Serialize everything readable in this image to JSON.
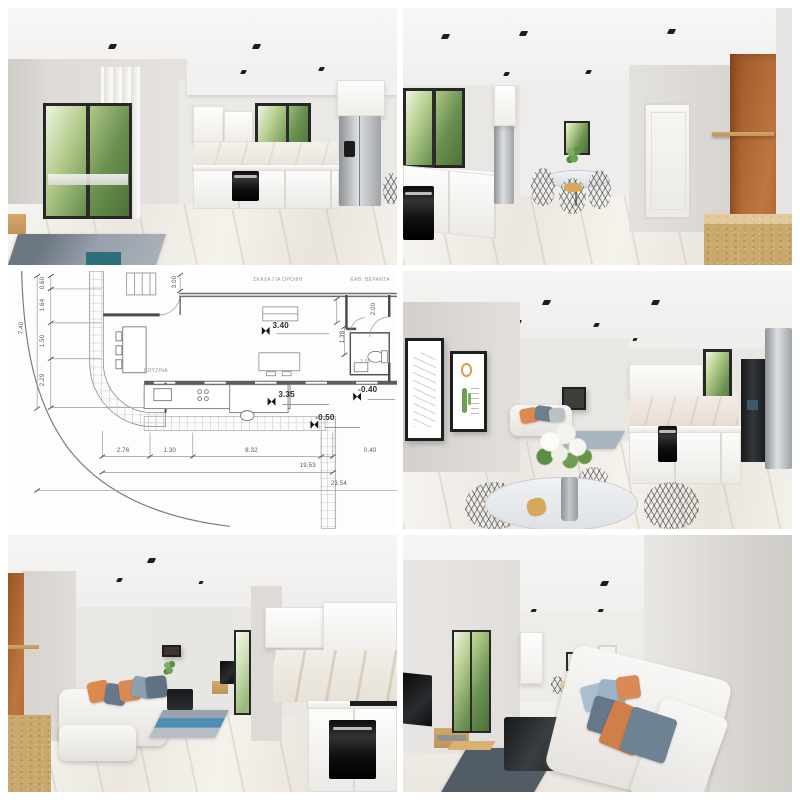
{
  "collage": {
    "layout": "2x3-grid",
    "gutter_color": "#ffffff",
    "panel_count": 6
  },
  "panels": [
    {
      "id": "kitchen-sliding-door",
      "kind": "3d-render",
      "label": "white kitchen with sliding balcony door"
    },
    {
      "id": "kitchen-dining-accent",
      "kind": "3d-render",
      "label": "kitchen and dining with terracotta accent wall"
    },
    {
      "id": "floor-plan",
      "kind": "architectural-drawing",
      "label": "ground floor plan with dimensions"
    },
    {
      "id": "living-dining-kitchen",
      "kind": "3d-render",
      "label": "open plan living with gallery wall and dining table"
    },
    {
      "id": "living-sofa-kitchen",
      "kind": "3d-render",
      "label": "living room sofa facing white kitchen"
    },
    {
      "id": "living-room-reverse",
      "kind": "3d-render",
      "label": "living room with tv wall and corner sofa"
    }
  ],
  "palette": {
    "wall_light": "#e7e5e2",
    "wall_shadow": "#d5d2cf",
    "ceiling": "#f6f5f3",
    "floor_marble": "#f0ede8",
    "terracotta": "#b46a33",
    "osb_wood": "#c9a96e",
    "greenery": "#7fa45c",
    "frame_dark": "#272727",
    "appliance_black": "#161616",
    "stainless": "#b9bcbf",
    "pillow_orange": "#dd8a50",
    "pillow_slate": "#6e7f8d",
    "pillow_blue": "#a9bfd0",
    "rug_gray": "#9aa3ad",
    "rug_blue": "#4f8fb5",
    "plan_line": "#6a6a6a",
    "plan_bg": "#fdfdfc"
  },
  "floor_plan": {
    "room_labels": {
      "stairs": "ΣΚΑΛΑ ΓΙΑ ΟΡΟΦΗ",
      "veranda": "ΚΑΘ. ΒΕΡΑΝΤΑ",
      "kitchen": "ΚΟΥΖΙΝΑ"
    },
    "levels": {
      "living": "3.40",
      "terrace": "3.35",
      "yard_upper": "-0.40",
      "yard_lower": "-0.50"
    },
    "dims": {
      "left_total": "7.40",
      "left_chain": [
        "0.60",
        "1.64",
        "1.50",
        "2.29"
      ],
      "door": "3.00",
      "right_chain": [
        "2.00",
        "1.38"
      ],
      "wc": "2.00",
      "bottom_chain": [
        "2.76",
        "1.30",
        "8.32",
        "0.40"
      ],
      "bottom_totals": [
        "19.53",
        "23.54"
      ]
    }
  }
}
